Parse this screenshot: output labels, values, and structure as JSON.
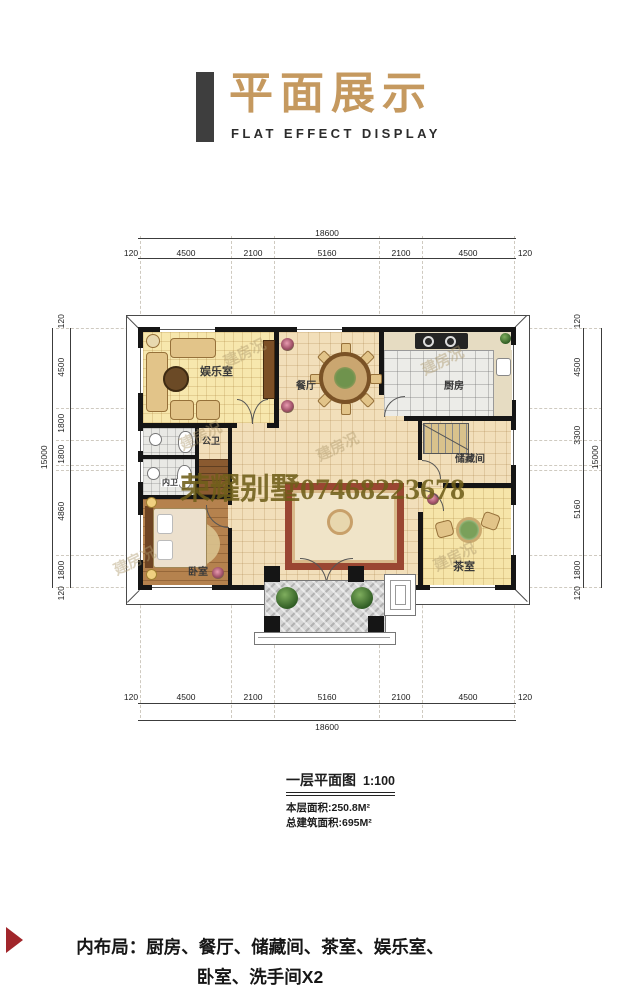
{
  "header": {
    "title": "平面展示",
    "subtitle": "FLAT EFFECT DISPLAY"
  },
  "plan": {
    "dims_horizontal": {
      "overall": "18600",
      "segments": [
        "120",
        "4500",
        "2100",
        "5160",
        "2100",
        "4500",
        "120"
      ]
    },
    "dims_left": {
      "overall": "15000",
      "segments": [
        "120",
        "4500",
        "1800",
        "1800",
        "4860",
        "1800",
        "120"
      ]
    },
    "dims_right": {
      "overall": "15000",
      "segments": [
        "120",
        "4500",
        "3300",
        "5160",
        "1800",
        "120"
      ]
    },
    "rooms": {
      "entertainment": "娱乐室",
      "dining": "餐厅",
      "kitchen": "厨房",
      "public_bath": "公卫",
      "ensuite_bath": "内卫",
      "storage": "储藏间",
      "bedroom": "卧室",
      "tea_room": "茶室"
    },
    "watermark_main": "荣耀别墅07468223678",
    "watermark_small": "建房况"
  },
  "caption": {
    "title": "一层平面图",
    "scale": "1:100",
    "floor_area": "本层面积:250.8M²",
    "total_area": "总建筑面积:695M²"
  },
  "footer": {
    "line1": "内布局：厨房、餐厅、储藏间、茶室、娱乐室、",
    "line2": "卧室、洗手间X2"
  },
  "colors": {
    "accent_gold": "#c5995f",
    "accent_red": "#a1262b",
    "header_bar": "#3e3e3e",
    "wall": "#151515",
    "floor_cream": "#f2dfba",
    "floor_yellow": "#f7e7ad",
    "floor_wood": "#b5824e",
    "floor_tea": "#f6e5a9",
    "kitchen_tile": "#ecece8"
  }
}
